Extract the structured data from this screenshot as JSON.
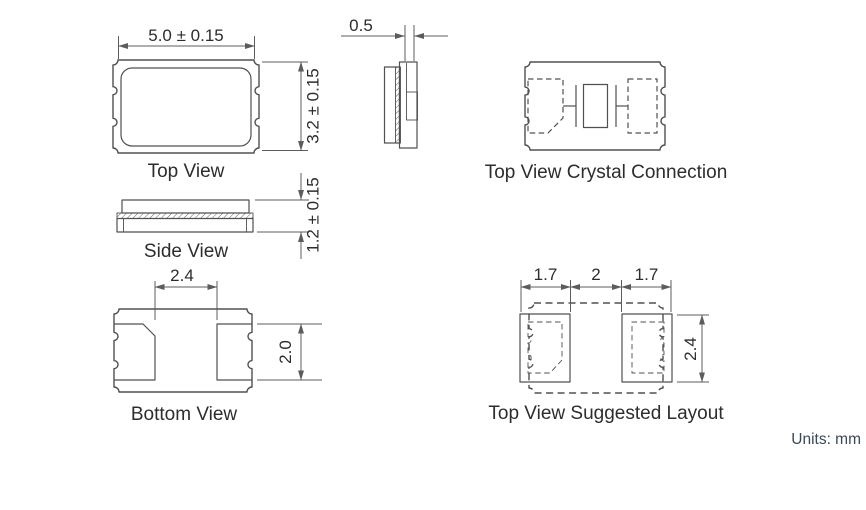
{
  "drawing": {
    "units_note": "Units: mm",
    "colors": {
      "background": "#ffffff",
      "line": "#4f5052",
      "dimension_line": "#5b5c5e",
      "text": "#2d2d2d",
      "units_text": "#3b4859"
    },
    "views": {
      "top": {
        "label": "Top View",
        "width_dim": "5.0 ± 0.15",
        "height_dim": "3.2 ± 0.15"
      },
      "end": {
        "lid_offset_dim": "0.5"
      },
      "side": {
        "label": "Side View",
        "thickness_dim": "1.2 ± 0.15"
      },
      "bottom": {
        "label": "Bottom View",
        "pad_inner_gap_dim": "2.4",
        "pad_height_dim": "2.0"
      },
      "crystal_connection": {
        "label": "Top View Crystal Connection"
      },
      "suggested_layout": {
        "label": "Top View Suggested Layout",
        "left_pad_width_dim": "1.7",
        "pad_gap_dim": "2",
        "right_pad_width_dim": "1.7",
        "pad_height_dim": "2.4"
      }
    }
  }
}
